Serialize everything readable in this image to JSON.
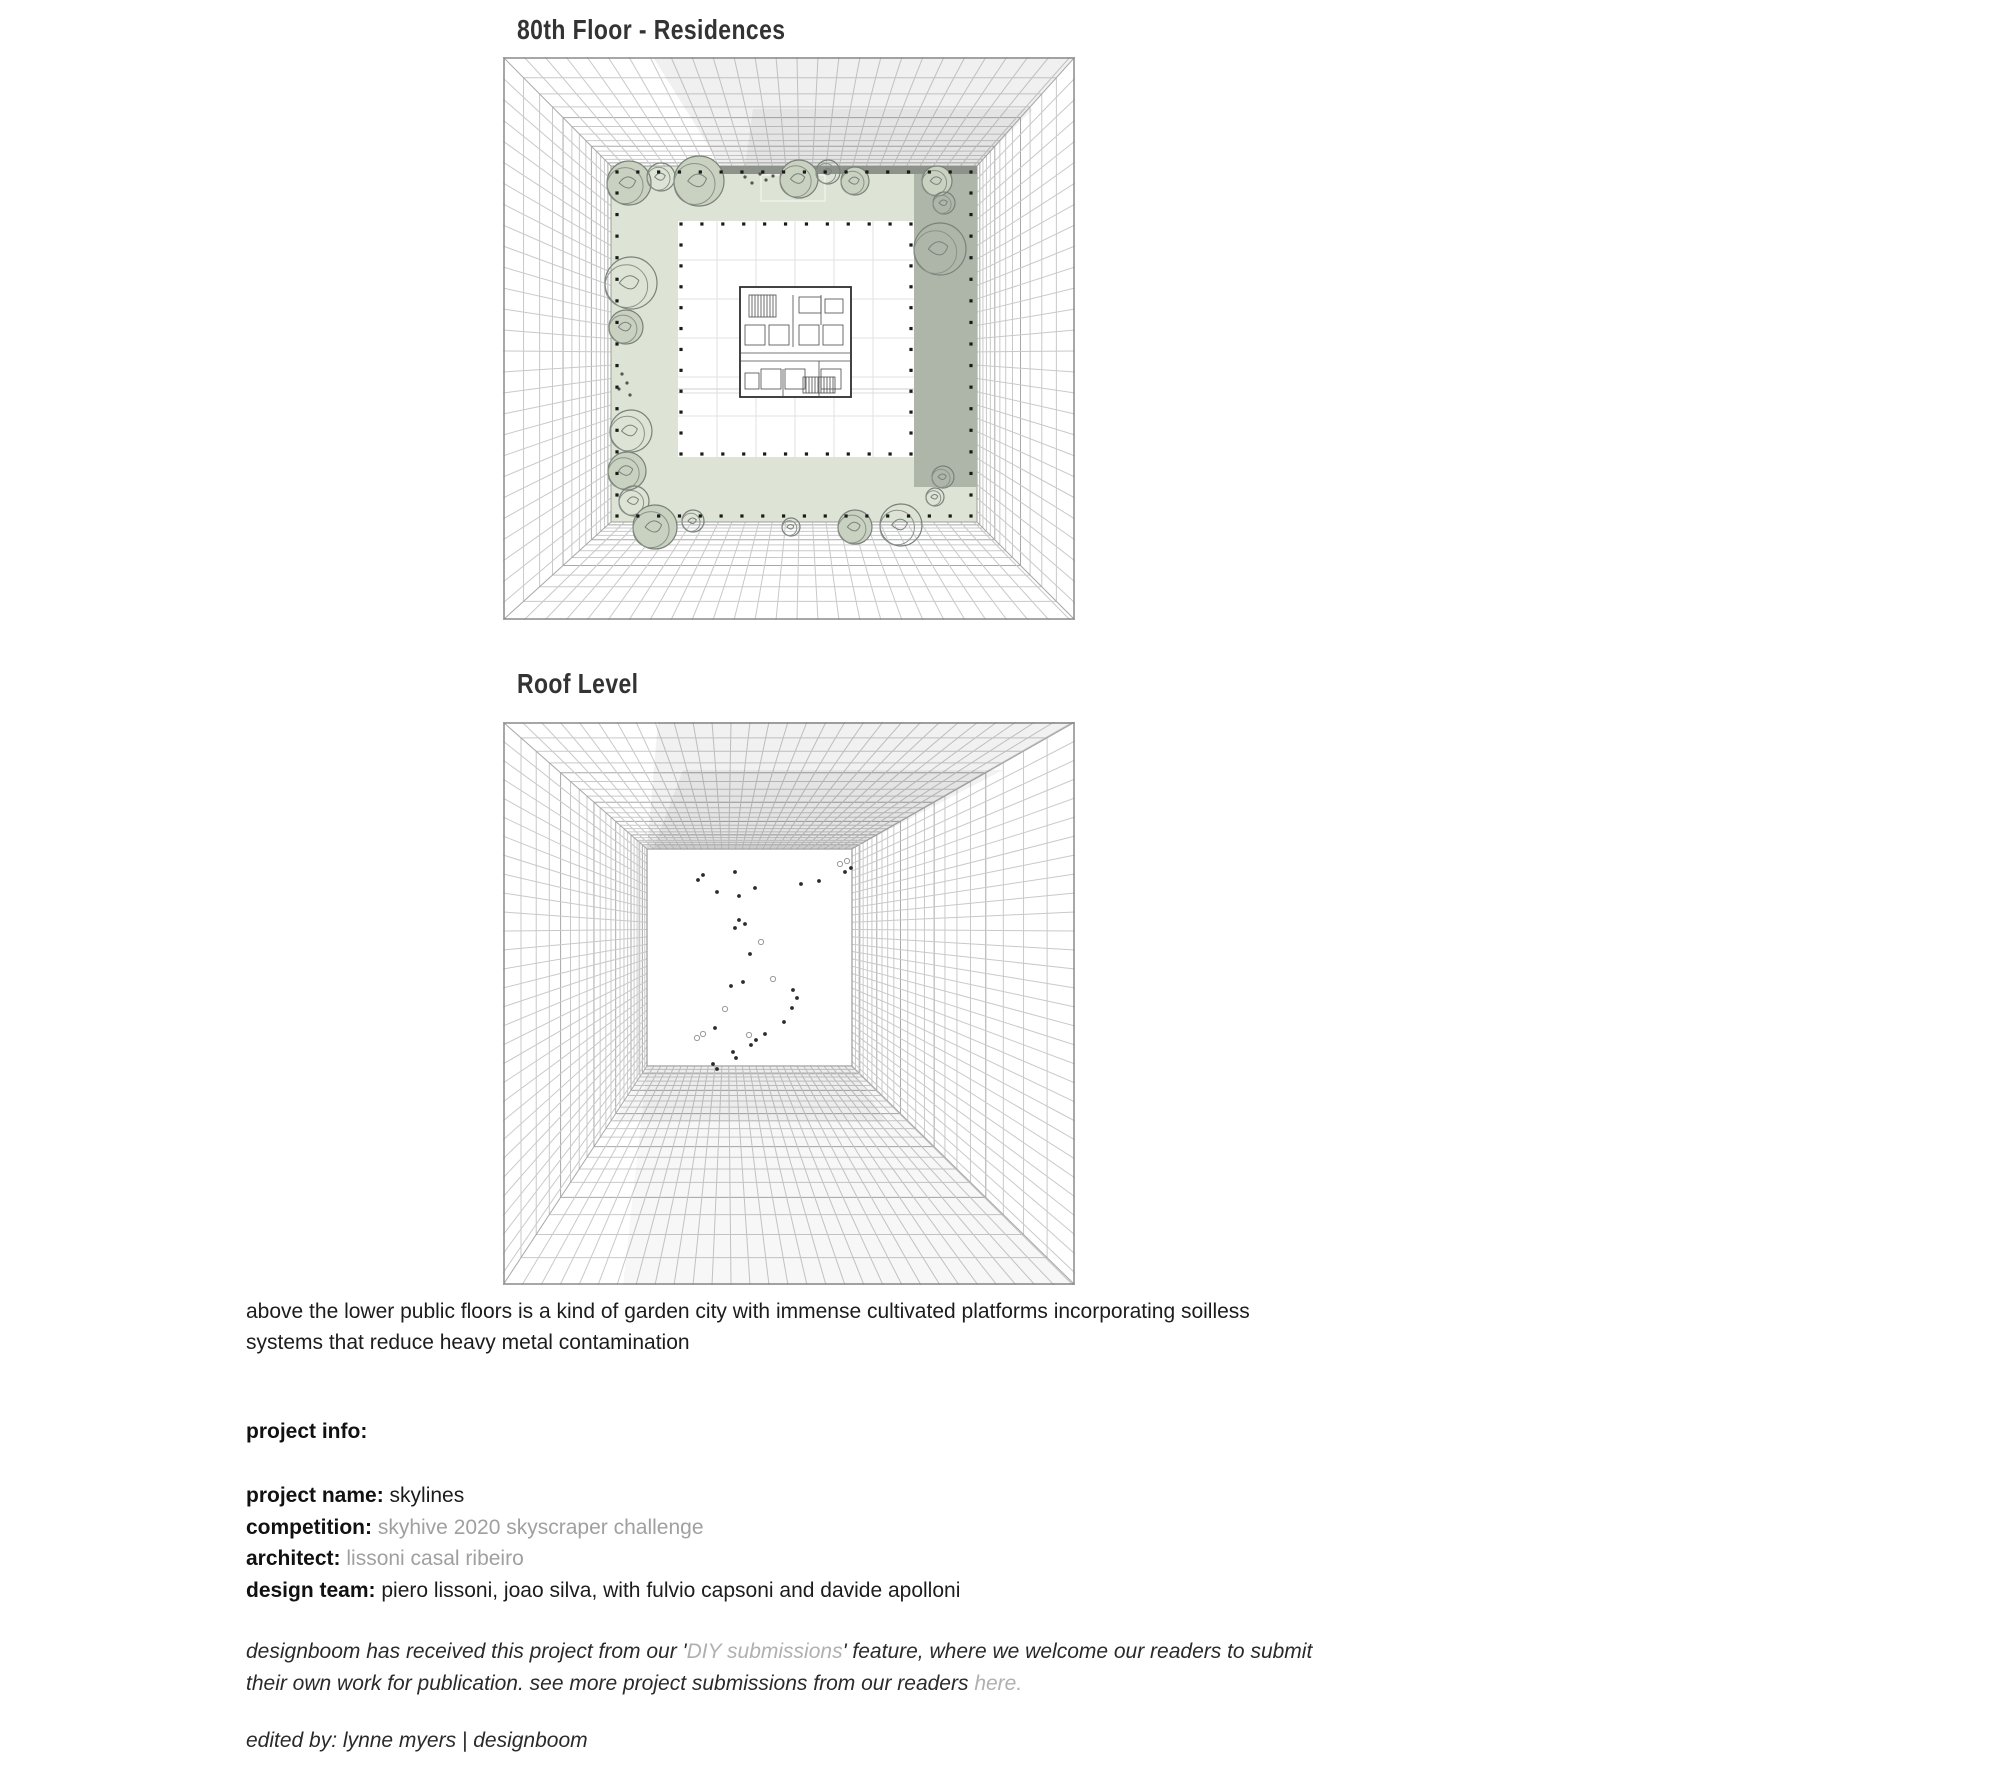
{
  "figures": [
    {
      "title": "80th Floor - Residences",
      "alt": "axonometric view looking down the tower shaft at the 80th floor: a planted green residential ring with trees around a white courtyard and a central unit floor plan"
    },
    {
      "title": "Roof Level",
      "alt": "axonometric view looking down the tower shaft at roof level: an open white roof deck with scattered small figures"
    }
  ],
  "caption": {
    "line1": "above the lower public floors is a kind of garden city with immense cultivated platforms incorporating soilless",
    "line2": "systems that reduce heavy metal contamination"
  },
  "project_info": {
    "heading": "project info:",
    "rows": [
      {
        "label": "project name:",
        "value": " skylines"
      },
      {
        "label": "competition:",
        "value": " skyhive 2020 skyscraper challenge"
      },
      {
        "label": "architect:",
        "value": " lissoni casal ribeiro"
      },
      {
        "label": "design team:",
        "value": " piero lissoni, joao silva, with fulvio capsoni and davide apolloni"
      }
    ]
  },
  "submission_note": {
    "part1": "designboom has received this project from our '",
    "link1": "DIY submissions",
    "part2": "' feature, where we welcome our readers to submit",
    "part3": "their own work for publication. see more project submissions from our readers ",
    "link2": "here."
  },
  "byline": "edited by: lynne myers | designboom",
  "colors": {
    "text": "#1c1c1c",
    "link_gray": "#a0a0a0",
    "garden_green": "#dde3d5",
    "shadow_band": "#aeb6a9",
    "grid_line": "#c6c6c6"
  }
}
